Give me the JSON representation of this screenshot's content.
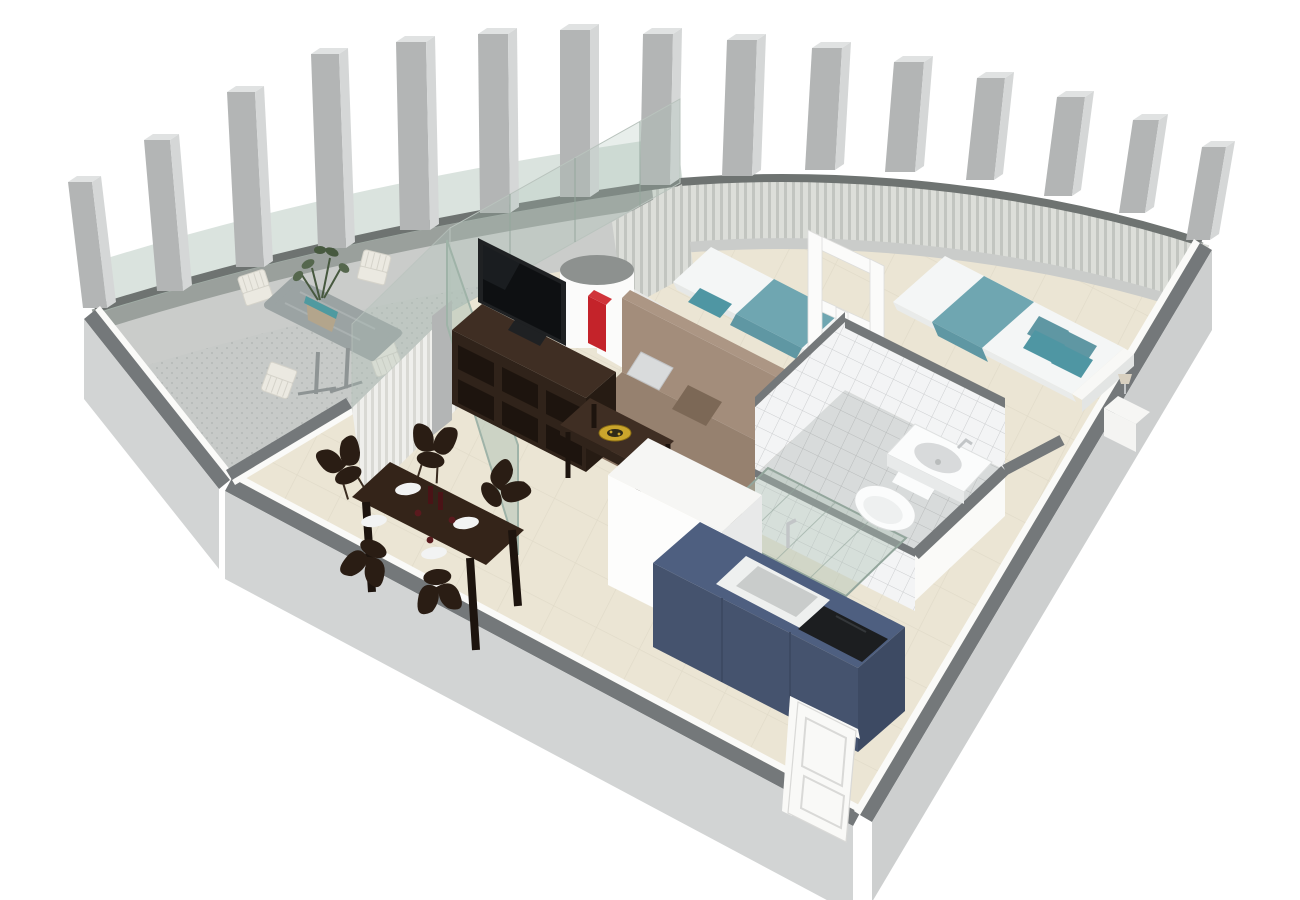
{
  "scene": {
    "type": "3d-floor-plan-render",
    "view": "isometric-cutaway",
    "rooms": [
      {
        "name": "balcony-terrace",
        "objects": [
          "colonnade of 15 concrete pillars",
          "glass balustrade panels",
          "stone patio table",
          "4 white slatted outdoor chairs",
          "potted plant with teal pot"
        ]
      },
      {
        "name": "living-dining-room",
        "objects": [
          "dark espresso tv stand with open cubbies",
          "flat screen tv",
          "red books on tv stand",
          "taupe futon sofa",
          "gray cushion",
          "brown cushion",
          "dark wood coffee table",
          "gold decorative plate",
          "espresso dining table",
          "5 sculpted dark chairs",
          "4 white plates",
          "wine bottles and glasses",
          "open tinted glass door",
          "white pleated curtains",
          "white round column partition"
        ]
      },
      {
        "name": "bedroom",
        "objects": [
          "single bed with teal blanket",
          "double bed with teal runner and 4 teal pillows",
          "white open doorway frame",
          "white nightstands",
          "small table lamp",
          "gray pleated curtain wall"
        ]
      },
      {
        "name": "bathroom",
        "objects": [
          "white wall tiles",
          "gray floor tiles",
          "toilet",
          "wall-hung washbasin with faucet",
          "tinted glass shower enclosure"
        ]
      },
      {
        "name": "kitchen",
        "objects": [
          "navy blue corner counter",
          "white square sink with faucet",
          "black cooktop",
          "tall white island block"
        ]
      },
      {
        "name": "entrance",
        "objects": [
          "white paneled entry door at bottom corner"
        ]
      }
    ],
    "counts": {
      "columns": 15,
      "outdoor_chairs": 4,
      "dining_chairs": 5,
      "dining_plates": 4,
      "beds": 2,
      "teal_pillows": 4,
      "nightstands": 2
    }
  },
  "colors": {
    "background": "#ffffff",
    "balcony_floor": "#c7cac8",
    "balcony_speckle": "#b4b8b6",
    "column_front": "#b3b5b5",
    "column_side": "#d5d7d7",
    "column_top": "#e0e2e2",
    "parapet_face": "#9aa09c",
    "parapet_top": "#6e7371",
    "parapet_exterior": "#caccca",
    "glass": "#aec2b6",
    "glass_frame": "#93a69c",
    "curtain_light": "#dcded9",
    "curtain_dark": "#c2c5c0",
    "curtain_white": "#efefec",
    "curtain_white_dark": "#d9d9d4",
    "wall_top_dark": "#74787a",
    "wall_exterior": "#d2d4d4",
    "wall_exterior_right": "#cdcfcf",
    "wall_interior": "#fafaf8",
    "floor_cream": "#ebe5d4",
    "floor_line": "#e0dac8",
    "partition_white": "#fbfbfa",
    "cylinder_top": "#8d918f",
    "sofa_seat": "#96816f",
    "sofa_back": "#a38d7b",
    "sofa_front": "#8a7564",
    "pillow_gray": "#d9dbdc",
    "pillow_brown": "#7c6856",
    "wood_top": "#3f2e23",
    "wood_dark": "#30231a",
    "wood_deep": "#1d140e",
    "tv_frame": "#1f2123",
    "tv_screen": "#0e1012",
    "red_accent": "#c4232a",
    "table_top": "#342419",
    "chair_dark": "#2a1d14",
    "plate_white": "#f2f3f3",
    "wine_dark": "#4a1316",
    "bed_white": "#f4f6f6",
    "bed_teal": "#6fa6b1",
    "bed_teal_dark": "#5f97a3",
    "pillow_teal": "#4f96a3",
    "headboard": "#f8f8f6",
    "nightstand": "#f4f4f2",
    "tile_wall": "#f3f4f5",
    "tile_wall_line": "#ccced0",
    "tile_floor": "#d8dbdb",
    "tile_floor_line": "#b9bcbc",
    "porcelain": "#fbfcfc",
    "porcelain_shadow": "#d8dadb",
    "metal": "#c2c5c7",
    "kitchen_top": "#4e5f80",
    "kitchen_front": "#45536e",
    "kitchen_side": "#3d4a63",
    "cooktop": "#1c1e20",
    "sink_inner": "#c9cccb",
    "island_top": "#f6f6f4",
    "island_front": "#fdfdfc",
    "island_side": "#e8e9e9",
    "door_white": "#f9f9f7",
    "door_edge": "#d9d9d7",
    "stone_table": "#9ba3a3",
    "stone_table_light": "#aab1b1",
    "chair_outdoor": "#ebe9e1",
    "chair_outdoor_line": "#d5d3ca",
    "plant_green": "#55674d",
    "plant_green_dark": "#47593f",
    "plant_pot": "#b3a58c",
    "pot_teal": "#4f9aa0"
  }
}
